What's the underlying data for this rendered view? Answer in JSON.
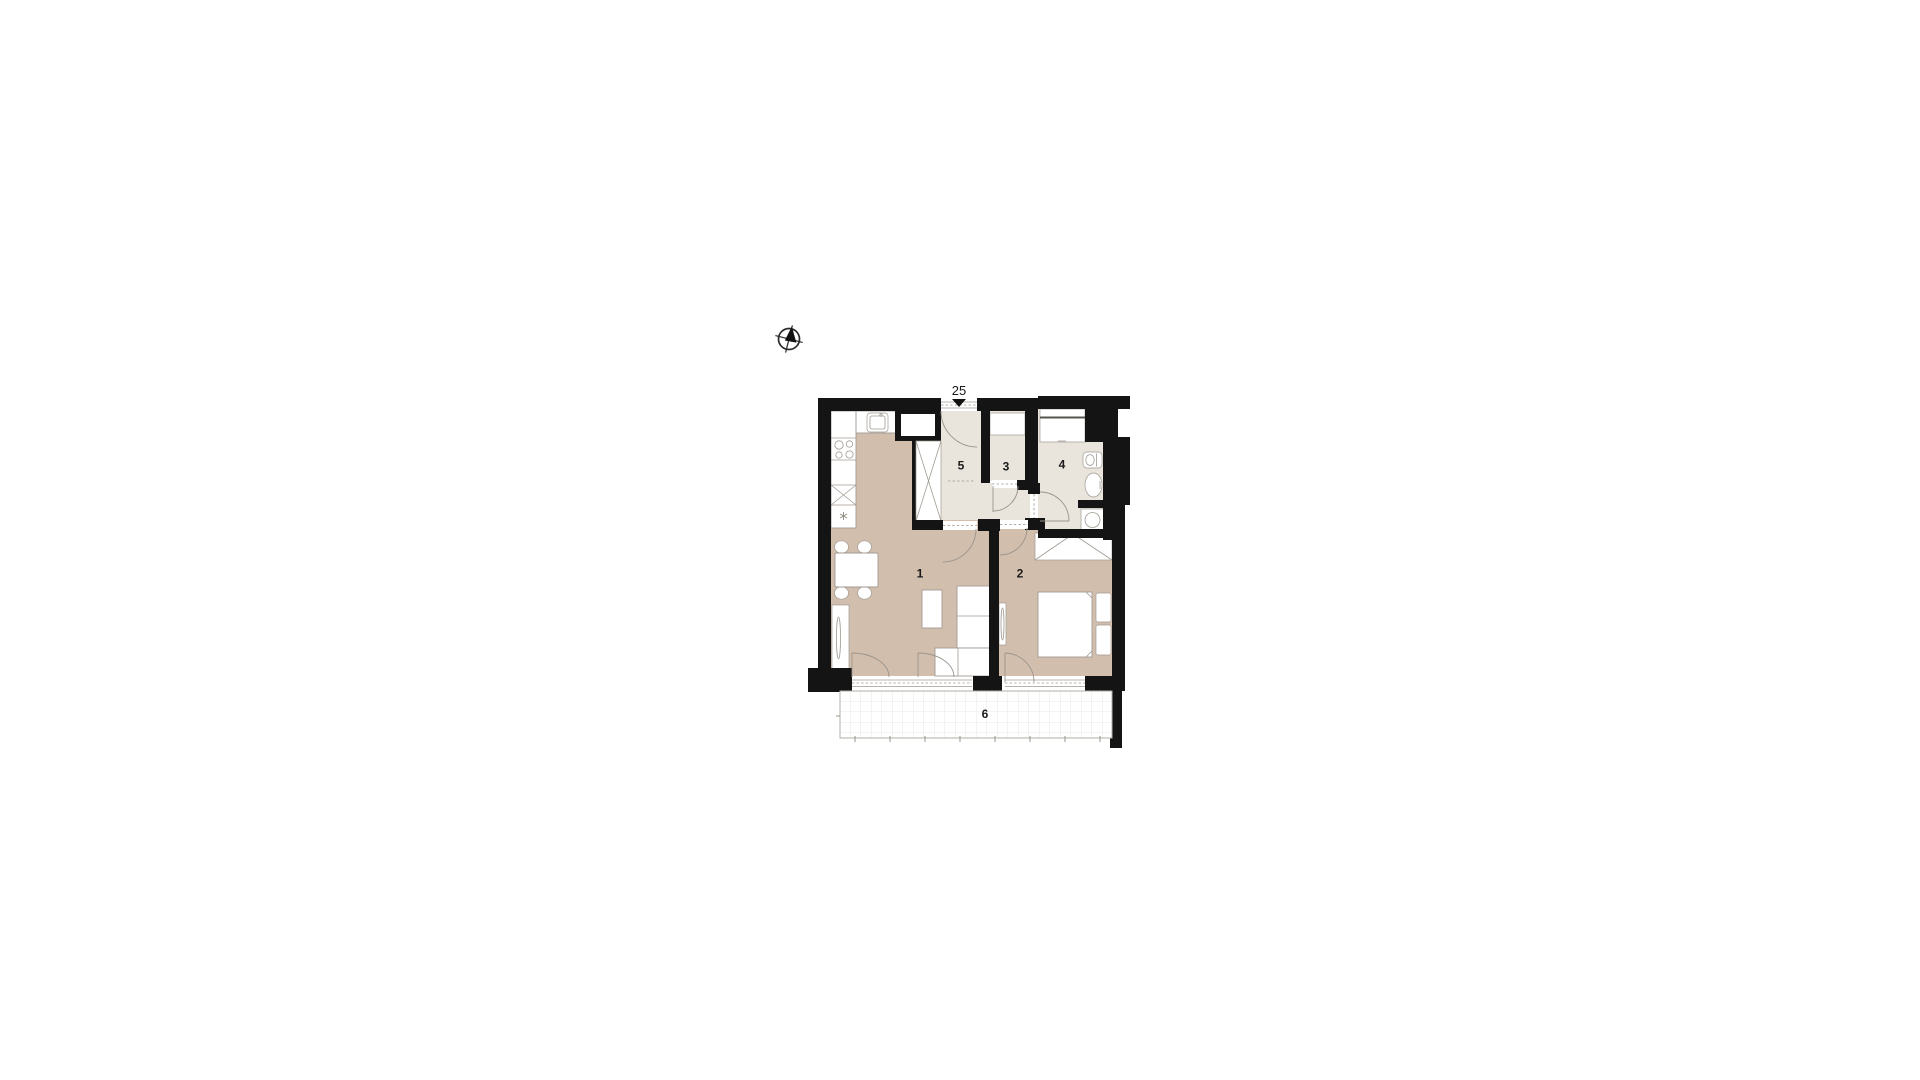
{
  "unit": {
    "number": "25"
  },
  "rooms": [
    {
      "id": "room-1-living-kitchen",
      "label": "1"
    },
    {
      "id": "room-2-bedroom",
      "label": "2"
    },
    {
      "id": "room-3-wc",
      "label": "3"
    },
    {
      "id": "room-4-bathroom",
      "label": "4"
    },
    {
      "id": "room-5-hall",
      "label": "5"
    },
    {
      "id": "room-6-balcony",
      "label": "6"
    }
  ],
  "icons": {
    "compass": "compass-rose",
    "entrance_marker": "entrance-arrow-down"
  },
  "colors": {
    "wall": "#141414",
    "floor_living": "#d2bead",
    "floor_service": "#e9e4dc",
    "furniture_outline": "#a09a92",
    "balcony_grid": "#e4e1da"
  }
}
